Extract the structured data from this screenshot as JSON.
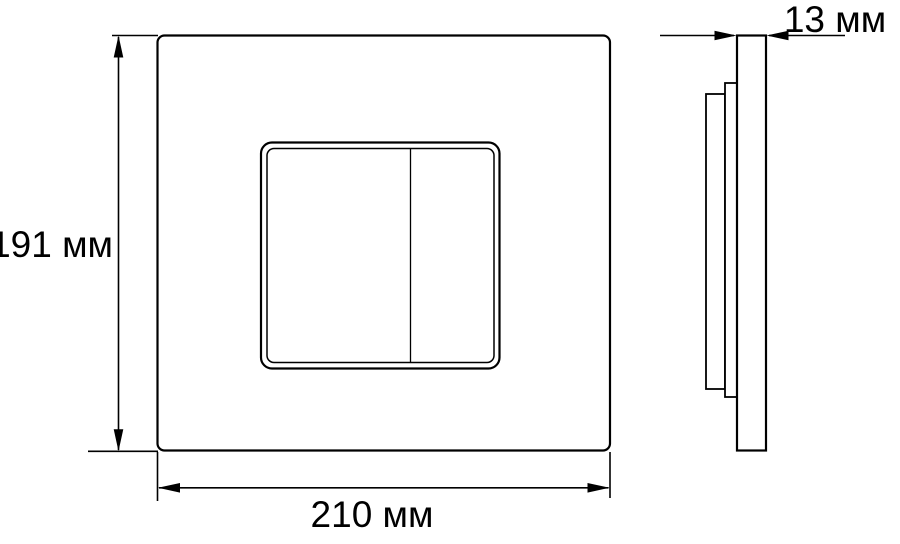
{
  "drawing": {
    "type": "technical-dimension-drawing",
    "subject": "dual-flush wall plate, front view and side profile view",
    "labels": {
      "height": "191 мм",
      "width": "210 мм",
      "depth": "13 мм"
    },
    "dimensions_mm": {
      "height": 191,
      "width": 210,
      "depth": 13
    },
    "colors": {
      "line": "#000000",
      "background": "#ffffff",
      "text": "#000000"
    }
  }
}
